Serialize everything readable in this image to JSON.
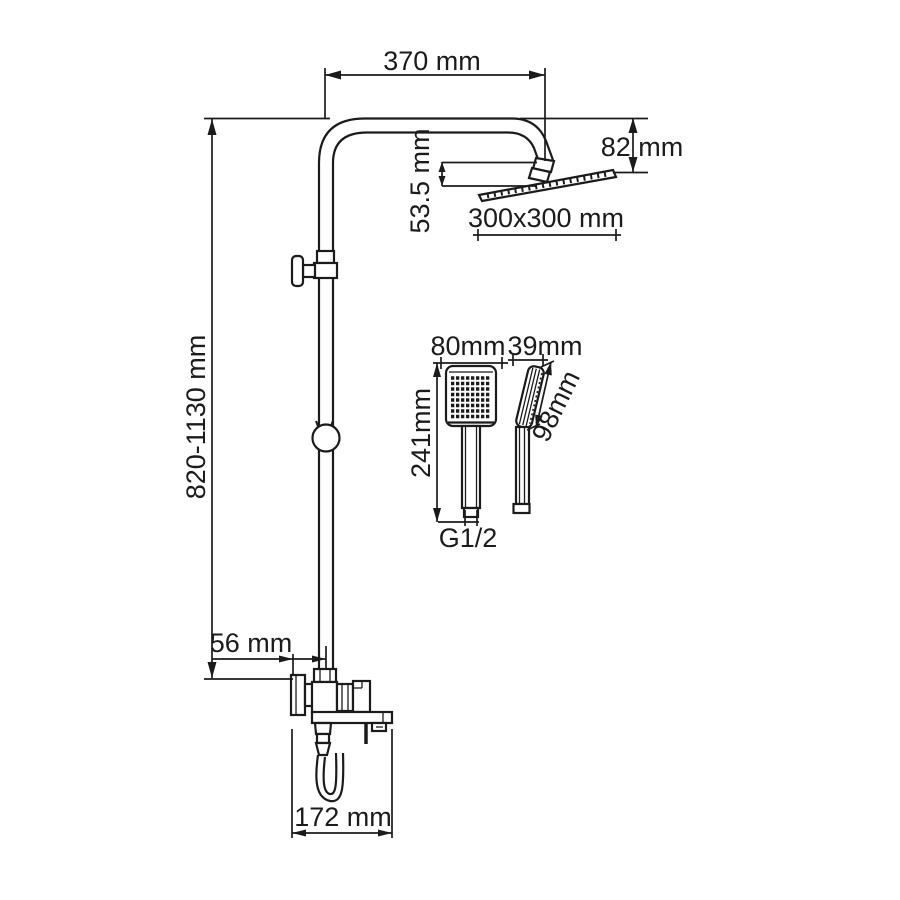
{
  "drawing": {
    "type": "shower-system-dimension-drawing",
    "colors": {
      "line": "#1b1b1b",
      "background": "#ffffff"
    },
    "labels": {
      "arm_reach": "370 mm",
      "head_height": "82 mm",
      "head_drop": "53.5 mm",
      "head_size": "300x300 mm",
      "column_height": "820-1130 mm",
      "handshower_width": "80mm",
      "handshower_depth": "39mm",
      "handshower_length": "241mm",
      "handshower_head_length": "98mm",
      "connection_thread": "G1/2",
      "wall_offset": "56 mm",
      "spout_reach": "172 mm"
    }
  }
}
